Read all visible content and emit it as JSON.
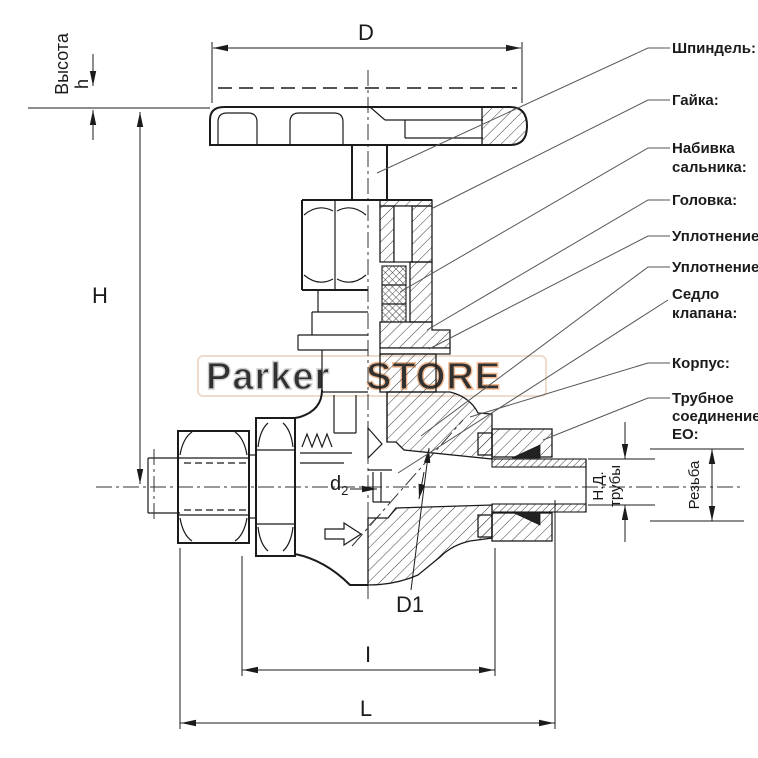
{
  "figure": {
    "type": "technical-sectional-drawing",
    "subject": "Needle valve with EO pipe connection, half section"
  },
  "dimension_labels": {
    "diameter_top": "D",
    "height_caption": "Высота",
    "height_small": "h",
    "height_overall": "H",
    "orifice_base": "d",
    "orifice_sub": "2",
    "bore_incline": "D1",
    "face_to_face": "I",
    "overall_length": "L",
    "pipe_od_line1": "Н.Д.",
    "pipe_od_line2": "трубы",
    "thread": "Резьба"
  },
  "part_labels": {
    "spindle": "Шпиндель:",
    "nut": "Гайка:",
    "packing_line1": "Набивка",
    "packing_line2": "сальника:",
    "head": "Головка:",
    "seal_upper": "Уплотнение:",
    "seal_lower": "Уплотнение:",
    "seat_line1": "Седло",
    "seat_line2": "клапана:",
    "body": "Корпус:",
    "eo_line1": "Трубное",
    "eo_line2": "соединение",
    "eo_line3": "EO:"
  },
  "watermark": {
    "part1": "Parker",
    "part2": "STORE"
  },
  "colors": {
    "line": "#1b1b1b",
    "leader": "#555555",
    "watermark_gray": "#c9c9c9",
    "watermark_orange": "#f0b184",
    "background": "#ffffff"
  }
}
